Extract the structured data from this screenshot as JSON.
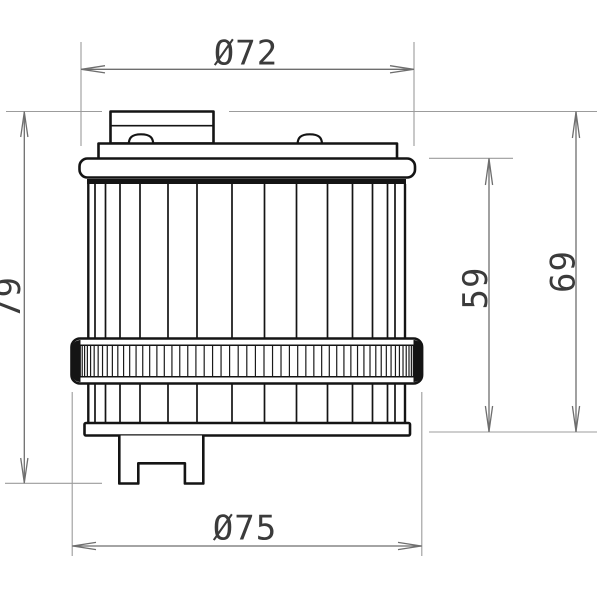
{
  "drawing": {
    "subject": "Cylindrical filter element, side elevation technical drawing",
    "dimensions": {
      "top_diameter": {
        "label": "Ø72",
        "value": 72,
        "orientation": "horizontal"
      },
      "bottom_diameter": {
        "label": "Ø75",
        "value": 75,
        "orientation": "horizontal"
      },
      "overall_height": {
        "label": "79",
        "value": 79,
        "orientation": "vertical"
      },
      "cap_height": {
        "label": "59",
        "value": 59,
        "orientation": "vertical"
      },
      "upper_height": {
        "label": "69",
        "value": 69,
        "orientation": "vertical"
      }
    },
    "colors": {
      "background": "#ffffff",
      "outline": "#141414",
      "dimension_line": "#6e6e6e",
      "extension_line": "#9c9c9c",
      "dimension_text": "#3b3b3b"
    }
  }
}
